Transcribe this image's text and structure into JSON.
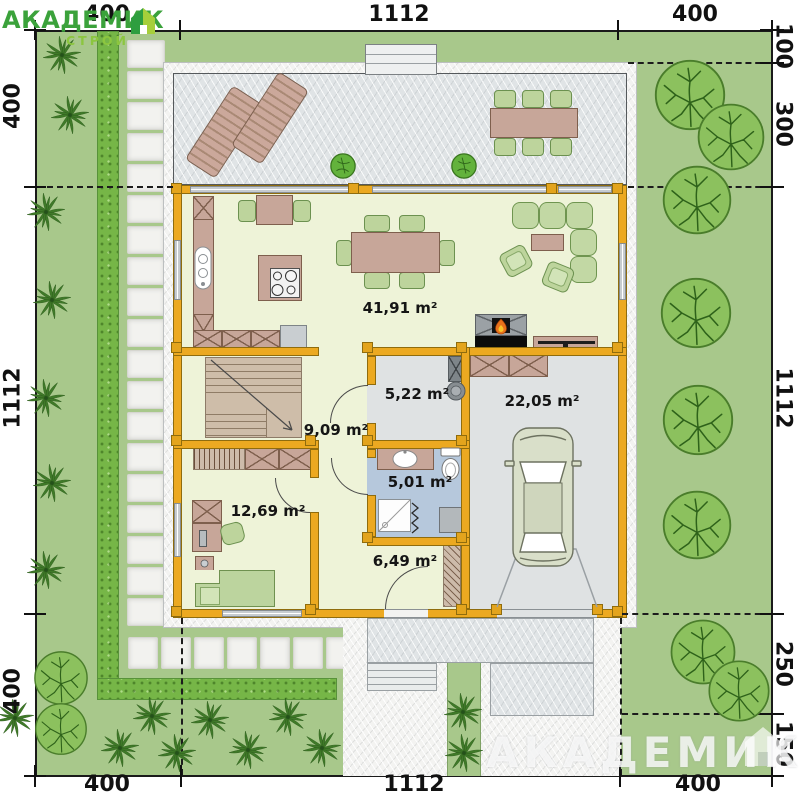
{
  "logo": {
    "brand": "АКАДЕМИК",
    "brand_sub": "СТРОЙ"
  },
  "watermark": {
    "brand": "АКАДЕМИК"
  },
  "dimensions": {
    "top": [
      "400",
      "1112",
      "400"
    ],
    "bottom": [
      "400",
      "1112",
      "400"
    ],
    "left": [
      "400",
      "1112",
      "400"
    ],
    "right": [
      "100",
      "300",
      "1112",
      "250",
      "150"
    ]
  },
  "rooms": [
    {
      "id": "living-dining-kitchen",
      "area_label": "41,91 m²"
    },
    {
      "id": "hallway",
      "area_label": "9,09 m²"
    },
    {
      "id": "utility",
      "area_label": "5,22 m²"
    },
    {
      "id": "garage",
      "area_label": "22,05 m²"
    },
    {
      "id": "bathroom",
      "area_label": "5,01 m²"
    },
    {
      "id": "study-bedroom",
      "area_label": "12,69 m²"
    },
    {
      "id": "entry-hall",
      "area_label": "6,49 m²"
    }
  ],
  "colors": {
    "site_green": "#a8c88b",
    "hedge_green": "#76b647",
    "wall_orange": "#eca921",
    "floor_pale": "#eef3d8",
    "floor_gray": "#dfe2e3",
    "floor_blue": "#b6c8dc",
    "logo_green": "#3ba23b"
  }
}
